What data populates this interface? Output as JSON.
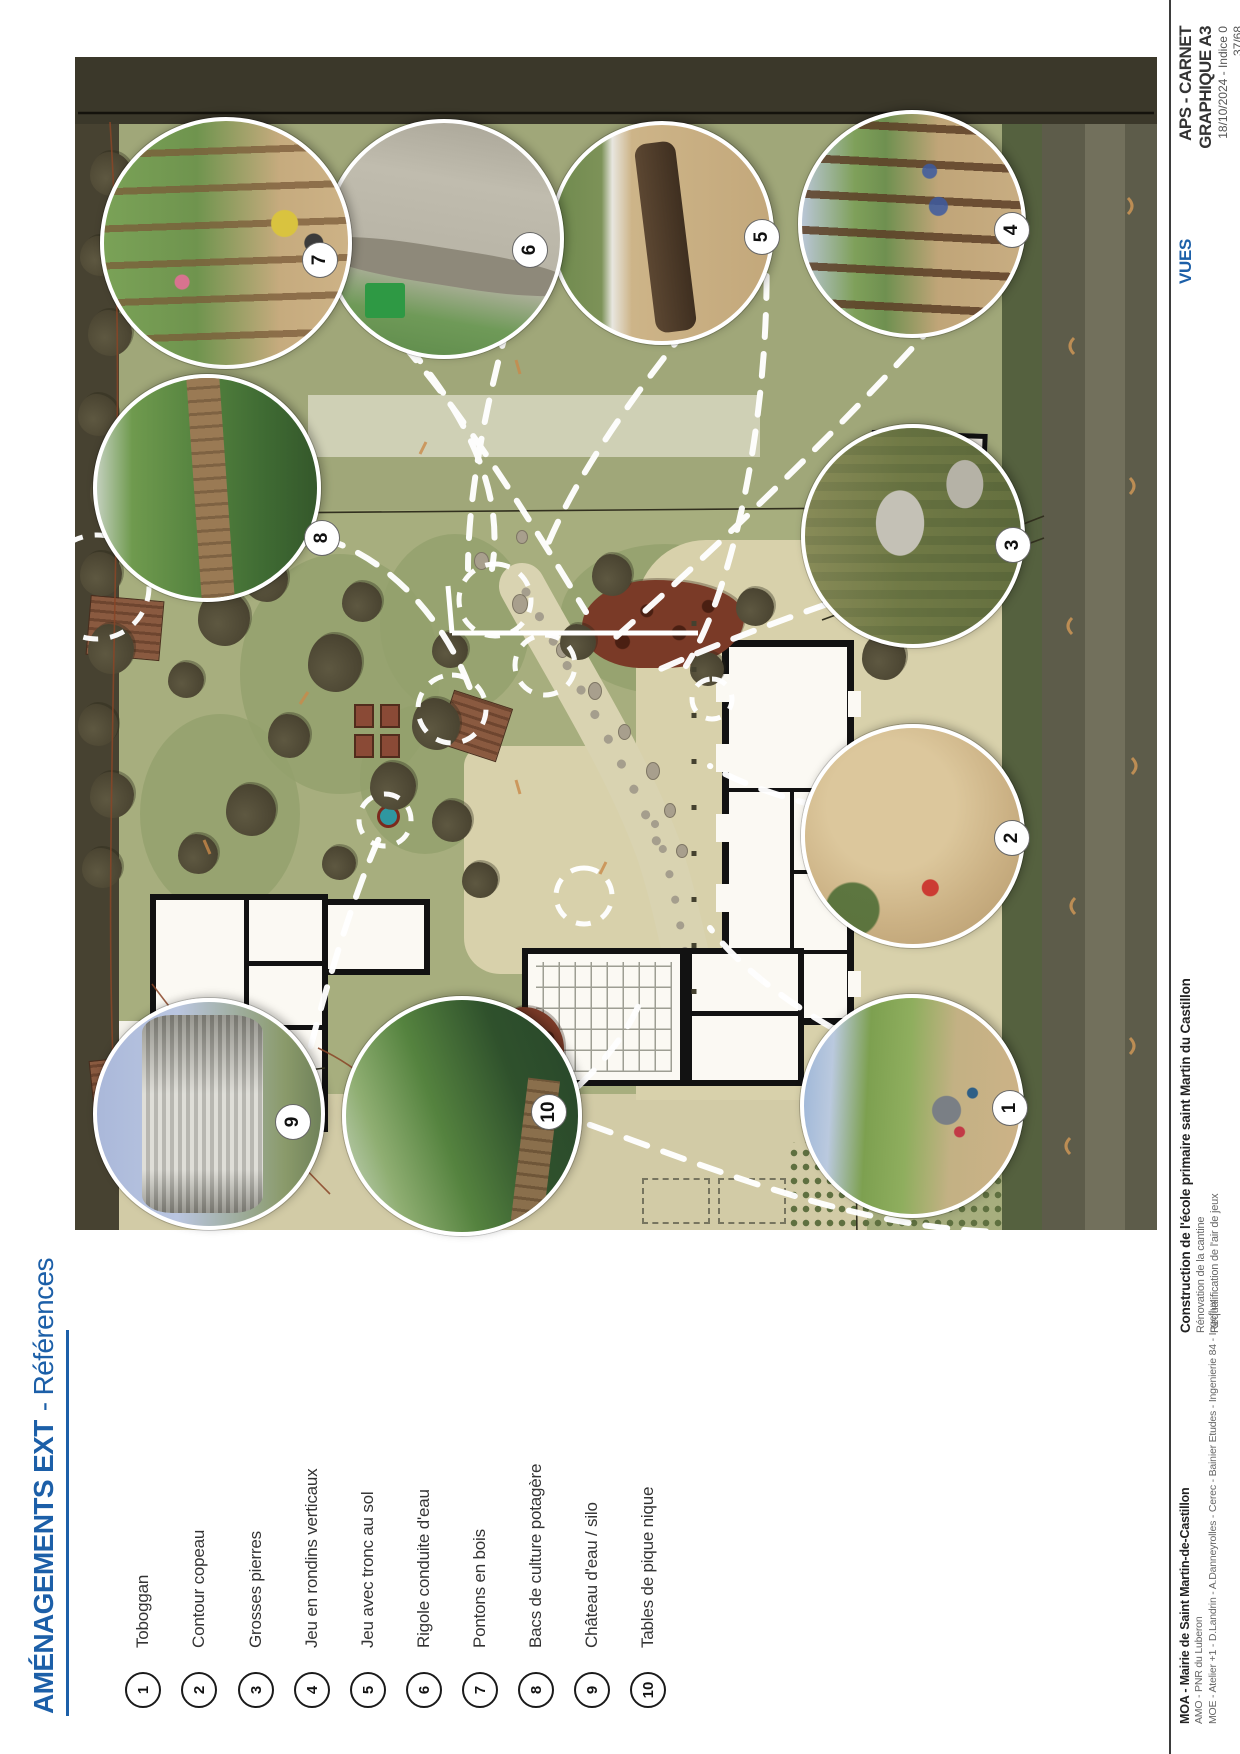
{
  "title": {
    "main": "AMÉNAGEMENTS EXT",
    "sub": "- Références"
  },
  "legend": {
    "items": [
      {
        "num": "1",
        "label": "Toboggan"
      },
      {
        "num": "2",
        "label": "Contour copeau"
      },
      {
        "num": "3",
        "label": "Grosses pierres"
      },
      {
        "num": "4",
        "label": "Jeu en rondins verticaux"
      },
      {
        "num": "5",
        "label": "Jeu avec tronc au sol"
      },
      {
        "num": "6",
        "label": "Rigole conduite d'eau"
      },
      {
        "num": "7",
        "label": "Pontons en bois"
      },
      {
        "num": "8",
        "label": "Bacs de culture potagère"
      },
      {
        "num": "9",
        "label": "Château d'eau / silo"
      },
      {
        "num": "10",
        "label": "Tables de pique nique"
      }
    ]
  },
  "footer": {
    "moa": "MOA - Mairie de Saint Martin-de-Castillon",
    "amo": "AMO - PNR du Luberon",
    "moe": "MOE - Atelier +1 - D.Landrin - A.Danneyrolles - Cerec - Bainier Etudes - Ingenierie 84 - Ingeflux",
    "project_bold": "Construction de l'école primaire saint Martin du Castillon",
    "project_line2": "Rénovation de la cantine",
    "project_line3": "Requalification de l'air de jeux",
    "views_label": "VUES",
    "doc_title": "APS - CARNET GRAPHIQUE A3",
    "date_line": "18/10/2024 - Indice 0",
    "page_num": "37/68"
  },
  "colors": {
    "accent_blue": "#1c5fa8"
  }
}
